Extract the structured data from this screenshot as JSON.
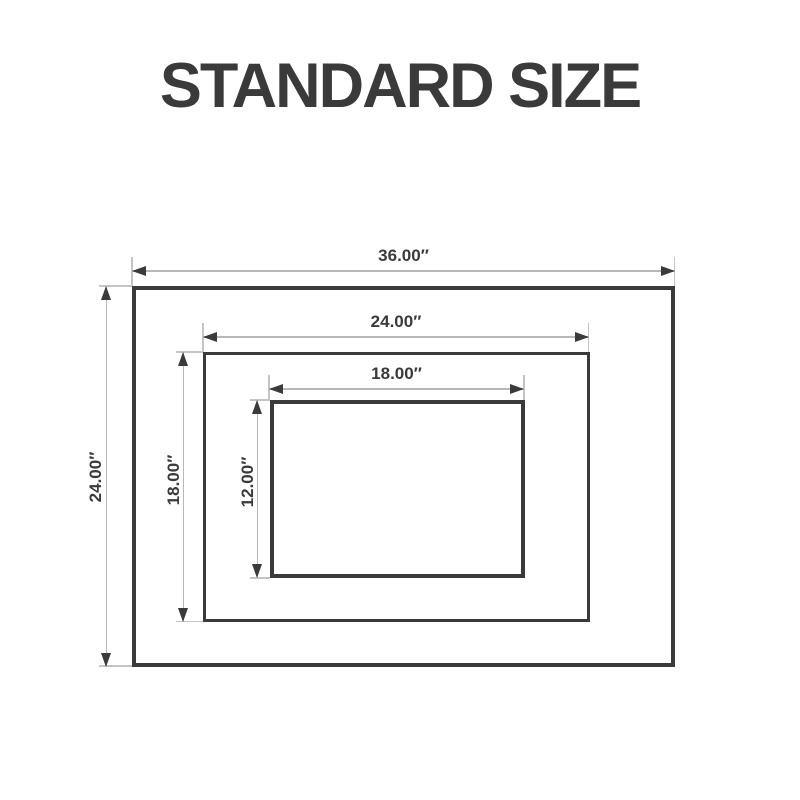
{
  "title": "STANDARD SIZE",
  "colors": {
    "ink": "#3a3a3a",
    "dimension_line": "#b8b8b8",
    "background": "#ffffff"
  },
  "dimensions": {
    "outer_width": "36.00″",
    "outer_height": "24.00″",
    "middle_width": "24.00″",
    "middle_height": "18.00″",
    "inner_width": "18.00″",
    "inner_height": "12.00″"
  }
}
